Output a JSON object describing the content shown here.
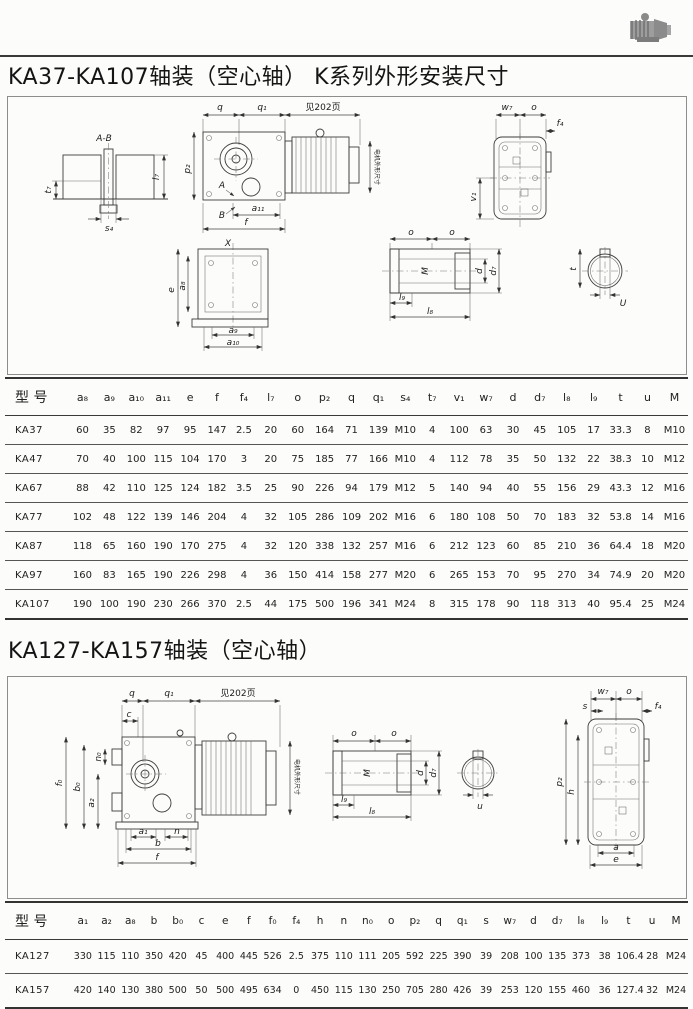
{
  "page": {
    "title1": "KA37-KA107轴装（空心轴）  K系列外形安装尺寸",
    "title2": "KA127-KA157轴装（空心轴）"
  },
  "drawing1": {
    "see_page": "见202页",
    "motor_note": "电机外形尺寸",
    "labels": {
      "ab": "A-B",
      "t7": "t₇",
      "l7": "l₇",
      "s4": "s₄",
      "q": "q",
      "q1": "q₁",
      "p2": "p₂",
      "A": "A",
      "B": "B",
      "a11": "a₁₁",
      "f": "f",
      "X": "X",
      "e": "e",
      "a8": "a₈",
      "a9": "a₉",
      "a10": "a₁₀",
      "o": "o",
      "M": "M",
      "d": "d",
      "d7": "d₇",
      "l8": "l₈",
      "l9": "l₉",
      "t": "t",
      "U": "U",
      "w7": "w₇",
      "f4": "f₄",
      "v1": "v₁"
    }
  },
  "drawing2": {
    "see_page": "见202页",
    "motor_note": "电机外形尺寸",
    "labels": {
      "q": "q",
      "q1": "q₁",
      "c": "c",
      "n0": "n₀",
      "f0": "f₀",
      "b0": "b₀",
      "a2": "a₂",
      "a1": "a₁",
      "n": "n",
      "b": "b",
      "f": "f",
      "o": "o",
      "M": "M",
      "d": "d",
      "d7": "d₇",
      "l8": "l₈",
      "l9": "l₉",
      "u": "u",
      "s": "s",
      "w7": "w₇",
      "f4": "f₄",
      "p2": "p₂",
      "h": "h",
      "a": "a",
      "e": "e"
    }
  },
  "table1": {
    "columns": [
      "型 号",
      "a₈",
      "a₉",
      "a₁₀",
      "a₁₁",
      "e",
      "f",
      "f₄",
      "l₇",
      "o",
      "p₂",
      "q",
      "q₁",
      "s₄",
      "t₇",
      "v₁",
      "w₇",
      "d",
      "d₇",
      "l₈",
      "l₉",
      "t",
      "u",
      "M"
    ],
    "rows": [
      [
        "KA37",
        "60",
        "35",
        "82",
        "97",
        "95",
        "147",
        "2.5",
        "20",
        "60",
        "164",
        "71",
        "139",
        "M10",
        "4",
        "100",
        "63",
        "30",
        "45",
        "105",
        "17",
        "33.3",
        "8",
        "M10"
      ],
      [
        "KA47",
        "70",
        "40",
        "100",
        "115",
        "104",
        "170",
        "3",
        "20",
        "75",
        "185",
        "77",
        "166",
        "M10",
        "4",
        "112",
        "78",
        "35",
        "50",
        "132",
        "22",
        "38.3",
        "10",
        "M12"
      ],
      [
        "KA67",
        "88",
        "42",
        "110",
        "125",
        "124",
        "182",
        "3.5",
        "25",
        "90",
        "226",
        "94",
        "179",
        "M12",
        "5",
        "140",
        "94",
        "40",
        "55",
        "156",
        "29",
        "43.3",
        "12",
        "M16"
      ],
      [
        "KA77",
        "102",
        "48",
        "122",
        "139",
        "146",
        "204",
        "4",
        "32",
        "105",
        "286",
        "109",
        "202",
        "M16",
        "6",
        "180",
        "108",
        "50",
        "70",
        "183",
        "32",
        "53.8",
        "14",
        "M16"
      ],
      [
        "KA87",
        "118",
        "65",
        "160",
        "190",
        "170",
        "275",
        "4",
        "32",
        "120",
        "338",
        "132",
        "257",
        "M16",
        "6",
        "212",
        "123",
        "60",
        "85",
        "210",
        "36",
        "64.4",
        "18",
        "M20"
      ],
      [
        "KA97",
        "160",
        "83",
        "165",
        "190",
        "226",
        "298",
        "4",
        "36",
        "150",
        "414",
        "158",
        "277",
        "M20",
        "6",
        "265",
        "153",
        "70",
        "95",
        "270",
        "34",
        "74.9",
        "20",
        "M20"
      ],
      [
        "KA107",
        "190",
        "100",
        "190",
        "230",
        "266",
        "370",
        "2.5",
        "44",
        "175",
        "500",
        "196",
        "341",
        "M24",
        "8",
        "315",
        "178",
        "90",
        "118",
        "313",
        "40",
        "95.4",
        "25",
        "M24"
      ]
    ]
  },
  "table2": {
    "columns": [
      "型 号",
      "a₁",
      "a₂",
      "a₈",
      "b",
      "b₀",
      "c",
      "e",
      "f",
      "f₀",
      "f₄",
      "h",
      "n",
      "n₀",
      "o",
      "p₂",
      "q",
      "q₁",
      "s",
      "w₇",
      "d",
      "d₇",
      "l₈",
      "l₉",
      "t",
      "u",
      "M"
    ],
    "rows": [
      [
        "KA127",
        "330",
        "115",
        "110",
        "350",
        "420",
        "45",
        "400",
        "445",
        "526",
        "2.5",
        "375",
        "110",
        "111",
        "205",
        "592",
        "225",
        "390",
        "39",
        "208",
        "100",
        "135",
        "373",
        "38",
        "106.4",
        "28",
        "M24"
      ],
      [
        "KA157",
        "420",
        "140",
        "130",
        "380",
        "500",
        "50",
        "500",
        "495",
        "634",
        "0",
        "450",
        "115",
        "130",
        "250",
        "705",
        "280",
        "426",
        "39",
        "253",
        "120",
        "155",
        "460",
        "36",
        "127.4",
        "32",
        "M24"
      ]
    ]
  }
}
